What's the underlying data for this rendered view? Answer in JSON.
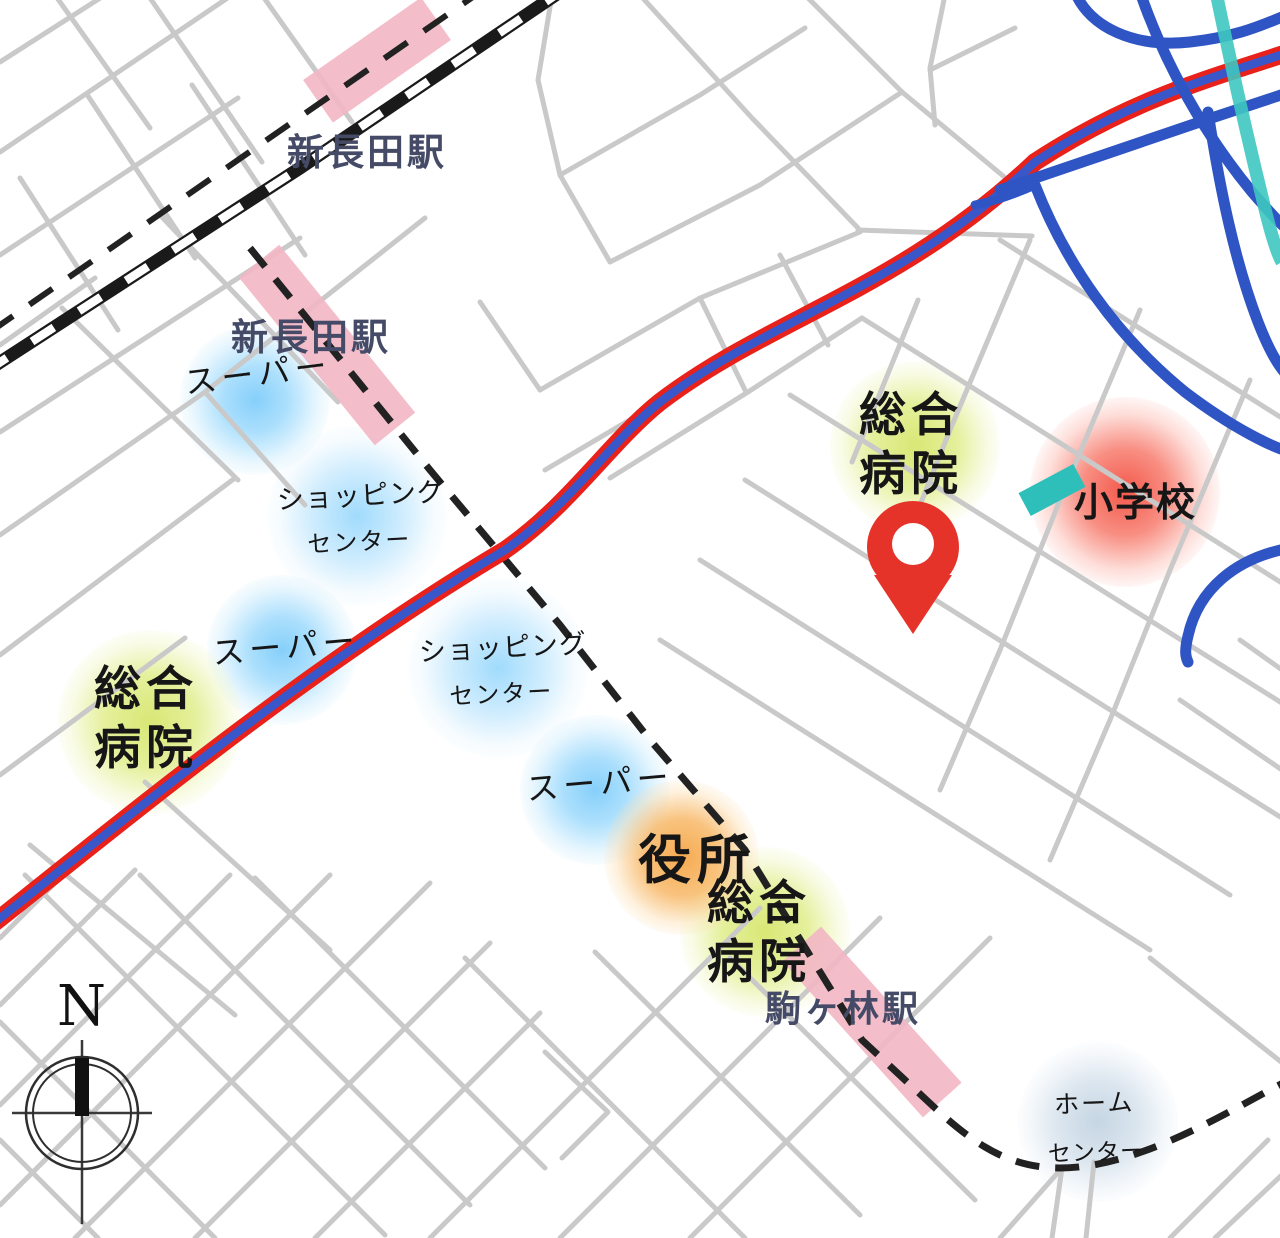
{
  "stations": {
    "jr_shin_nagata": {
      "name": "新長田駅"
    },
    "subway_shin_nagata": {
      "name": "新長田駅"
    },
    "komagabayashi": {
      "name": "駒ヶ林駅"
    }
  },
  "pois": {
    "supermarket_1": {
      "name": "スーパー"
    },
    "supermarket_2": {
      "name": "スーパー"
    },
    "supermarket_3": {
      "name": "スーパー"
    },
    "shopping_center_1": {
      "line1": "ショッピング",
      "line2": "センター"
    },
    "shopping_center_2": {
      "line1": "ショッピング",
      "line2": "センター"
    },
    "general_hospital_1": {
      "line1": "総合",
      "line2": "病院"
    },
    "general_hospital_2": {
      "line1": "総合",
      "line2": "病院"
    },
    "general_hospital_3": {
      "line1": "総合",
      "line2": "病院"
    },
    "city_office": {
      "name": "役所"
    },
    "elementary_school": {
      "name": "小学校"
    },
    "home_center": {
      "line1": "ホーム",
      "line2": "センター"
    }
  },
  "compass": {
    "north_label": "N"
  },
  "colors": {
    "main_road_red": "#e8211b",
    "main_road_blue": "#3a57c9",
    "expressway_blue": "#2f55c4",
    "subway_line_teal": "#3ec6c0",
    "station_highlight_pink": "#f2b6c5",
    "school_marker_teal": "#2fbfba",
    "supermarket_glow": "#80cdfa",
    "hospital_glow": "#d6e66e",
    "city_office_glow": "#f5a546",
    "school_glow": "#f24b3c",
    "home_center_glow": "#a5bed7",
    "pin_red": "#e6332a",
    "street_gray": "#c9c9c9",
    "station_text": "#454b66"
  }
}
